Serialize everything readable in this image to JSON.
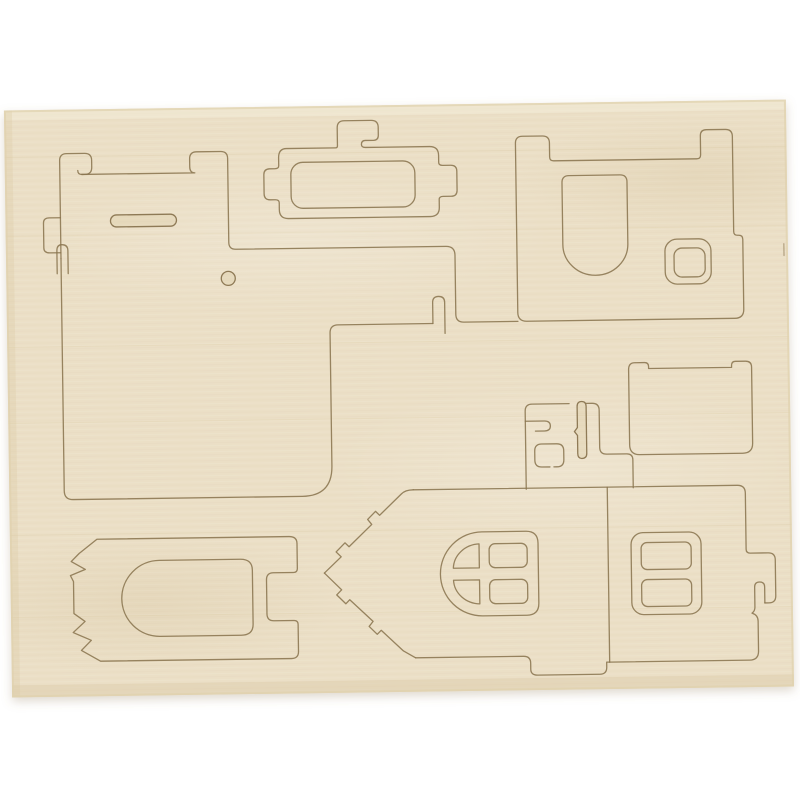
{
  "scene": {
    "description": "Photo of a laser-cut plywood craft sheet with punch-out pieces for assembling a small 3D wooden house",
    "colors": {
      "background": "#ffffff",
      "wood_base": "#ebdfc6",
      "wood_light": "#f4edda",
      "wood_dark": "#e0d1ae",
      "cut_line": "#8a7550",
      "slot_fill": "#d8c69c",
      "shadow": "rgba(140,115,75,0.28)"
    },
    "board": {
      "material": "plywood-sheet",
      "orientation_deg": -0.8
    },
    "pieces": [
      {
        "id": "roof-panel-top-left",
        "kind": "notched panel with hook slots"
      },
      {
        "id": "floor-panel",
        "kind": "large panel with pill slot, round hole and side tabs"
      },
      {
        "id": "side-wall-panel",
        "kind": "panel with top tab and inner rectangular opening"
      },
      {
        "id": "door-wall-panel",
        "kind": "panel with arched doorway and small square window frame"
      },
      {
        "id": "chimney-parts",
        "kind": "small piece with keyhole slot, hook slot and square cutout"
      },
      {
        "id": "small-wall-panel",
        "kind": "rounded rectangle panel with corner ears"
      },
      {
        "id": "arched-door-panel",
        "kind": "panel with arched door cutout and zigzag edge"
      },
      {
        "id": "gable-end-panel",
        "kind": "pointed gable piece with four-pane arched window"
      },
      {
        "id": "window-wall-panel",
        "kind": "panel with two-pane window and side tab"
      }
    ]
  }
}
